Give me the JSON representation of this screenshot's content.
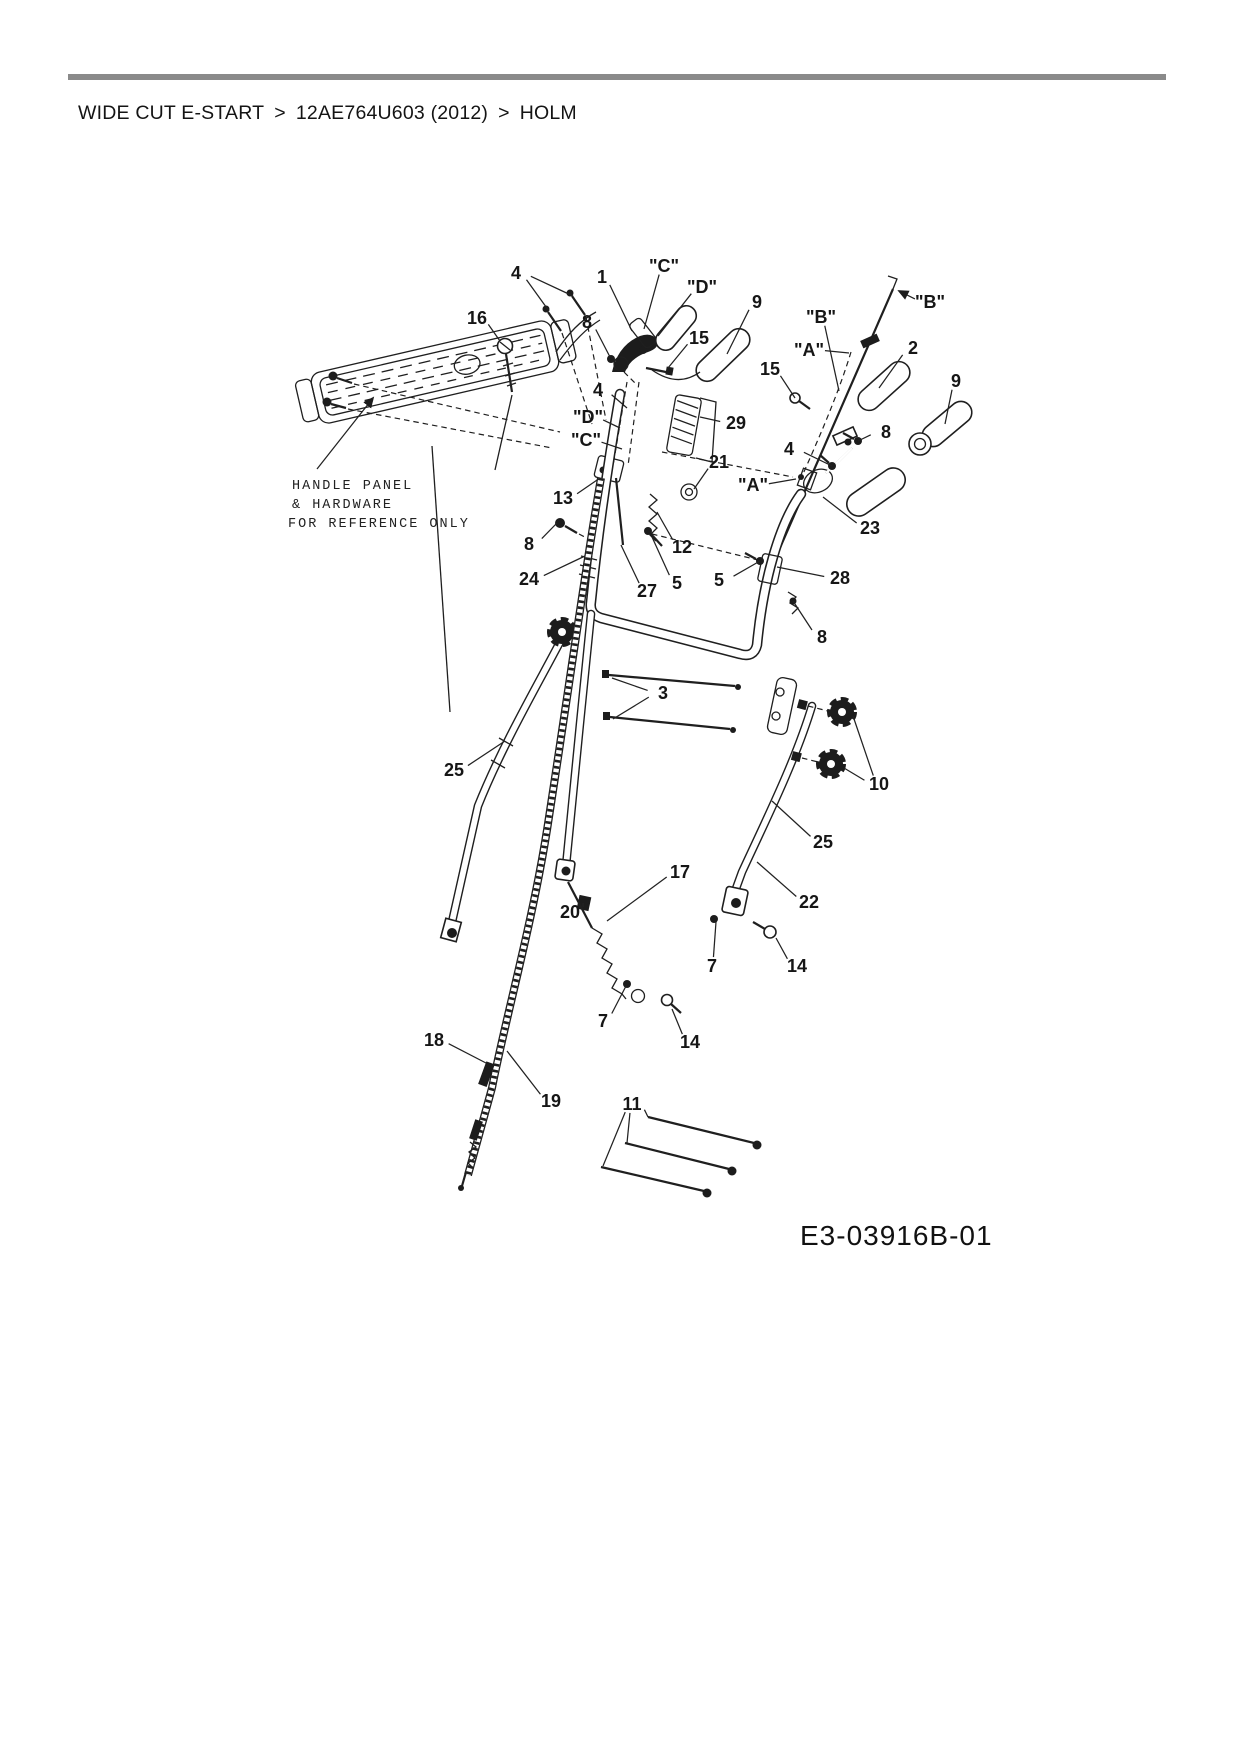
{
  "header": {
    "breadcrumb": {
      "items": [
        "WIDE CUT E-START",
        "12AE764U603 (2012)",
        "HOLM"
      ],
      "separator": ">"
    }
  },
  "diagram": {
    "drawing_id": "E3-03916B-01",
    "reference_note": {
      "lines": [
        "HANDLE PANEL",
        "& HARDWARE",
        "FOR REFERENCE ONLY"
      ]
    },
    "colors": {
      "ink": "#1f1f1f",
      "rule": "#8a8a8a",
      "background": "#ffffff"
    },
    "callouts": [
      {
        "label": "4",
        "x": 516,
        "y": 273,
        "leaders": [
          [
            549,
            311
          ],
          [
            573,
            296
          ]
        ]
      },
      {
        "label": "16",
        "x": 477,
        "y": 318,
        "leaders": [
          [
            500,
            341
          ]
        ]
      },
      {
        "label": "1",
        "x": 602,
        "y": 277,
        "leaders": [
          [
            632,
            331
          ]
        ]
      },
      {
        "label": "\"C\"",
        "x": 664,
        "y": 266,
        "leaders": [
          [
            644,
            329
          ]
        ]
      },
      {
        "label": "\"D\"",
        "x": 702,
        "y": 287,
        "leaders": [
          [
            658,
            336
          ]
        ]
      },
      {
        "label": "8",
        "x": 587,
        "y": 322,
        "leaders": [
          [
            610,
            357
          ]
        ]
      },
      {
        "label": "15",
        "x": 699,
        "y": 338,
        "leaders": [
          [
            668,
            368
          ]
        ]
      },
      {
        "label": "9",
        "x": 757,
        "y": 302,
        "leaders": [
          [
            727,
            354
          ]
        ]
      },
      {
        "label": "\"B\"",
        "x": 821,
        "y": 317,
        "leaders": [
          [
            839,
            391
          ]
        ]
      },
      {
        "label": "\"B\"",
        "x": 930,
        "y": 302,
        "leaders": [
          [
            899,
            291
          ]
        ],
        "arrow": true
      },
      {
        "label": "\"A\"",
        "x": 809,
        "y": 350,
        "leaders": [
          [
            849,
            353
          ]
        ]
      },
      {
        "label": "15",
        "x": 770,
        "y": 369,
        "leaders": [
          [
            795,
            398
          ]
        ]
      },
      {
        "label": "2",
        "x": 913,
        "y": 348,
        "leaders": [
          [
            879,
            388
          ]
        ]
      },
      {
        "label": "9",
        "x": 956,
        "y": 381,
        "leaders": [
          [
            945,
            424
          ]
        ]
      },
      {
        "label": "8",
        "x": 886,
        "y": 432,
        "leaders": [
          [
            858,
            441
          ]
        ]
      },
      {
        "label": "4",
        "x": 789,
        "y": 449,
        "leaders": [
          [
            832,
            466
          ]
        ]
      },
      {
        "label": "29",
        "x": 736,
        "y": 423,
        "leaders": [
          [
            700,
            417
          ]
        ]
      },
      {
        "label": "21",
        "x": 719,
        "y": 462,
        "leaders": [
          [
            694,
            489
          ]
        ]
      },
      {
        "label": "\"A\"",
        "x": 753,
        "y": 485,
        "leaders": [
          [
            796,
            479
          ]
        ]
      },
      {
        "label": "23",
        "x": 870,
        "y": 528,
        "leaders": [
          [
            823,
            497
          ]
        ]
      },
      {
        "label": "28",
        "x": 840,
        "y": 578,
        "leaders": [
          [
            777,
            567
          ]
        ]
      },
      {
        "label": "8",
        "x": 822,
        "y": 637,
        "leaders": [
          [
            793,
            601
          ]
        ]
      },
      {
        "label": "13",
        "x": 563,
        "y": 498,
        "leaders": [
          [
            600,
            478
          ]
        ]
      },
      {
        "label": "\"D\"",
        "x": 588,
        "y": 417,
        "leaders": [
          [
            620,
            428
          ]
        ]
      },
      {
        "label": "\"C\"",
        "x": 586,
        "y": 440,
        "leaders": [
          [
            622,
            449
          ]
        ]
      },
      {
        "label": "4",
        "x": 598,
        "y": 390,
        "leaders": [
          [
            627,
            408
          ]
        ]
      },
      {
        "label": "8",
        "x": 529,
        "y": 544,
        "leaders": [
          [
            557,
            523
          ]
        ]
      },
      {
        "label": "12",
        "x": 682,
        "y": 547,
        "leaders": [
          [
            657,
            512
          ]
        ]
      },
      {
        "label": "24",
        "x": 529,
        "y": 579,
        "leaders": [
          [
            585,
            556
          ]
        ]
      },
      {
        "label": "27",
        "x": 647,
        "y": 591,
        "leaders": [
          [
            621,
            545
          ]
        ]
      },
      {
        "label": "5",
        "x": 677,
        "y": 583,
        "leaders": [
          [
            652,
            537
          ]
        ]
      },
      {
        "label": "5",
        "x": 719,
        "y": 580,
        "leaders": [
          [
            760,
            561
          ]
        ]
      },
      {
        "label": "3",
        "x": 663,
        "y": 693,
        "leaders": [
          [
            612,
            678
          ],
          [
            613,
            719
          ]
        ]
      },
      {
        "label": "25",
        "x": 454,
        "y": 770,
        "leaders": [
          [
            505,
            741
          ]
        ]
      },
      {
        "label": "10",
        "x": 879,
        "y": 784,
        "leaders": [
          [
            853,
            716
          ],
          [
            844,
            768
          ]
        ]
      },
      {
        "label": "25",
        "x": 823,
        "y": 842,
        "leaders": [
          [
            772,
            801
          ]
        ]
      },
      {
        "label": "17",
        "x": 680,
        "y": 872,
        "leaders": [
          [
            607,
            921
          ]
        ]
      },
      {
        "label": "20",
        "x": 570,
        "y": 912,
        "leaders": [
          [
            583,
            903
          ]
        ]
      },
      {
        "label": "22",
        "x": 809,
        "y": 902,
        "leaders": [
          [
            757,
            862
          ]
        ]
      },
      {
        "label": "7",
        "x": 712,
        "y": 966,
        "leaders": [
          [
            716,
            922
          ]
        ]
      },
      {
        "label": "14",
        "x": 797,
        "y": 966,
        "leaders": [
          [
            776,
            938
          ]
        ]
      },
      {
        "label": "7",
        "x": 603,
        "y": 1021,
        "leaders": [
          [
            626,
            986
          ]
        ]
      },
      {
        "label": "14",
        "x": 690,
        "y": 1042,
        "leaders": [
          [
            672,
            1009
          ]
        ]
      },
      {
        "label": "18",
        "x": 434,
        "y": 1040,
        "leaders": [
          [
            486,
            1063
          ]
        ]
      },
      {
        "label": "19",
        "x": 551,
        "y": 1101,
        "leaders": [
          [
            507,
            1051
          ]
        ]
      },
      {
        "label": "11",
        "x": 632,
        "y": 1104,
        "leaders": [
          [
            648,
            1117
          ],
          [
            627,
            1143
          ],
          [
            603,
            1166
          ]
        ]
      }
    ]
  }
}
